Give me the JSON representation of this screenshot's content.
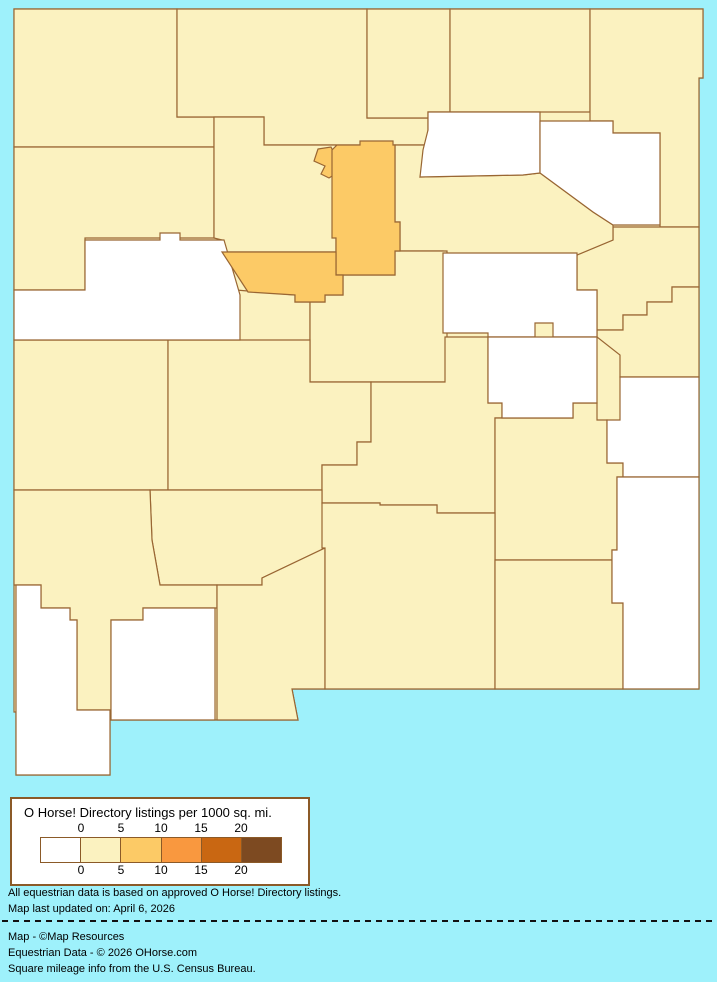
{
  "palette": {
    "background": "#9EF1FB",
    "county_border": "#996633",
    "legend_box_border": "#8B5A28",
    "cat_0": "#FFFFFF",
    "cat_0_5": "#FBF2C0",
    "cat_5_10": "#FCCA66",
    "cat_10_15": "#F9983F",
    "cat_15_20": "#C96712",
    "cat_20_plus": "#7D4A21",
    "text": "#000000"
  },
  "legend": {
    "title": "O Horse! Directory listings per 1000 sq. mi.",
    "ticks_top": [
      "0",
      "5",
      "10",
      "15",
      "20"
    ],
    "ticks_bottom": [
      "0",
      "5",
      "10",
      "15",
      "20"
    ],
    "swatches": [
      "#FFFFFF",
      "#FBF2C0",
      "#FCCA66",
      "#F9983F",
      "#C96712",
      "#7D4A21"
    ]
  },
  "notes": {
    "line1": "All equestrian data is based on approved O Horse! Directory listings.",
    "line2": "Map last updated on: April 6, 2026"
  },
  "credits": {
    "line1": "Map - ©Map Resources",
    "line2": "Equestrian Data - © 2026 OHorse.com",
    "line3": "Square mileage info from the U.S. Census Bureau."
  },
  "map_data": {
    "type": "choropleth",
    "region": "New Mexico counties",
    "value_label": "O Horse! Directory listings per 1000 sq. mi.",
    "class_breaks": [
      0,
      5,
      10,
      15,
      20
    ],
    "classes_shown": [
      "0",
      "0-5",
      "5-10"
    ],
    "counties": [
      {
        "name": "San Juan",
        "class": "0-5"
      },
      {
        "name": "Rio Arriba",
        "class": "0-5"
      },
      {
        "name": "Taos",
        "class": "0-5"
      },
      {
        "name": "Colfax",
        "class": "0-5"
      },
      {
        "name": "Union",
        "class": "0-5"
      },
      {
        "name": "McKinley",
        "class": "0-5"
      },
      {
        "name": "Sandoval",
        "class": "0-5"
      },
      {
        "name": "Mora",
        "class": "0"
      },
      {
        "name": "Harding",
        "class": "0"
      },
      {
        "name": "Quay",
        "class": "0-5"
      },
      {
        "name": "Cibola",
        "class": "0"
      },
      {
        "name": "Los Alamos",
        "class": "5-10"
      },
      {
        "name": "Santa Fe",
        "class": "5-10"
      },
      {
        "name": "San Miguel",
        "class": "0-5"
      },
      {
        "name": "Bernalillo",
        "class": "5-10"
      },
      {
        "name": "Valencia",
        "class": "0-5"
      },
      {
        "name": "Torrance",
        "class": "0-5"
      },
      {
        "name": "Guadalupe",
        "class": "0"
      },
      {
        "name": "Curry",
        "class": "0-5"
      },
      {
        "name": "De Baca",
        "class": "0"
      },
      {
        "name": "Roosevelt",
        "class": "0"
      },
      {
        "name": "Catron",
        "class": "0-5"
      },
      {
        "name": "Socorro",
        "class": "0-5"
      },
      {
        "name": "Lincoln",
        "class": "0-5"
      },
      {
        "name": "Chaves",
        "class": "0-5"
      },
      {
        "name": "Sierra",
        "class": "0-5"
      },
      {
        "name": "Grant",
        "class": "0-5"
      },
      {
        "name": "Hidalgo",
        "class": "0"
      },
      {
        "name": "Luna",
        "class": "0"
      },
      {
        "name": "Dona Ana",
        "class": "0-5"
      },
      {
        "name": "Otero",
        "class": "0-5"
      },
      {
        "name": "Eddy",
        "class": "0-5"
      },
      {
        "name": "Lea",
        "class": "0"
      }
    ]
  }
}
